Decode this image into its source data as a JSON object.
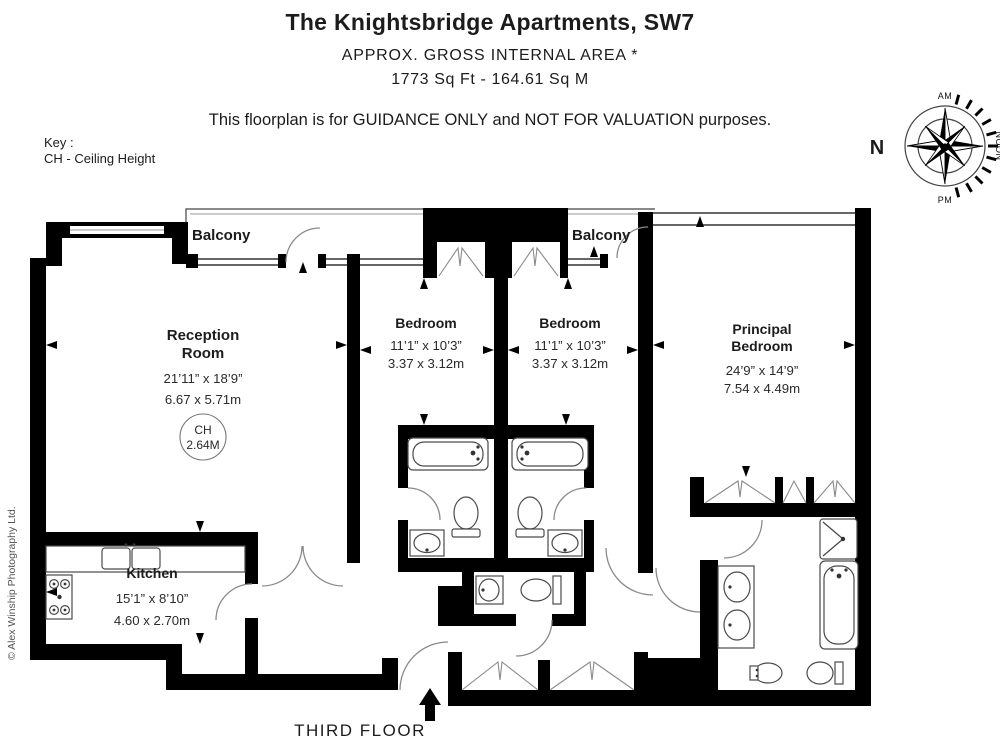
{
  "header": {
    "title": "The Knightsbridge Apartments, SW7",
    "area_label": "APPROX. GROSS INTERNAL  AREA *",
    "area_value": "1773 Sq Ft  -  164.61 Sq M",
    "disclaimer": "This floorplan is for GUIDANCE ONLY and NOT FOR VALUATION purposes."
  },
  "key": {
    "label": "Key :",
    "entry": "CH - Ceiling Height"
  },
  "compass": {
    "north": "N",
    "am": "AM",
    "noon": "NOON",
    "pm": "PM"
  },
  "floor_label": "THIRD FLOOR",
  "credit": "© Alex Winship Photography Ltd.",
  "rooms": {
    "balcony_left": {
      "name": "Balcony"
    },
    "balcony_right": {
      "name": "Balcony"
    },
    "reception": {
      "name": "Reception Room",
      "name_lines": [
        "Reception",
        "Room"
      ],
      "imperial": "21’11” x 18’9”",
      "metric": "6.67 x 5.71m",
      "ceiling": {
        "line1": "CH",
        "line2": "2.64M"
      }
    },
    "bedroom1": {
      "name": "Bedroom",
      "imperial": "11’1” x 10’3”",
      "metric": "3.37 x 3.12m"
    },
    "bedroom2": {
      "name": "Bedroom",
      "imperial": "11’1” x 10’3”",
      "metric": "3.37 x 3.12m"
    },
    "principal": {
      "name": "Principal Bedroom",
      "name_lines": [
        "Principal",
        "Bedroom"
      ],
      "imperial": "24’9” x 14’9”",
      "metric": "7.54 x 4.49m"
    },
    "kitchen": {
      "name": "Kitchen",
      "imperial": "15’1” x 8’10”",
      "metric": "4.60 x 2.70m"
    }
  },
  "colors": {
    "wall": "#000000",
    "fixture_stroke": "#4a4a4a",
    "text": "#1c1c1c"
  }
}
